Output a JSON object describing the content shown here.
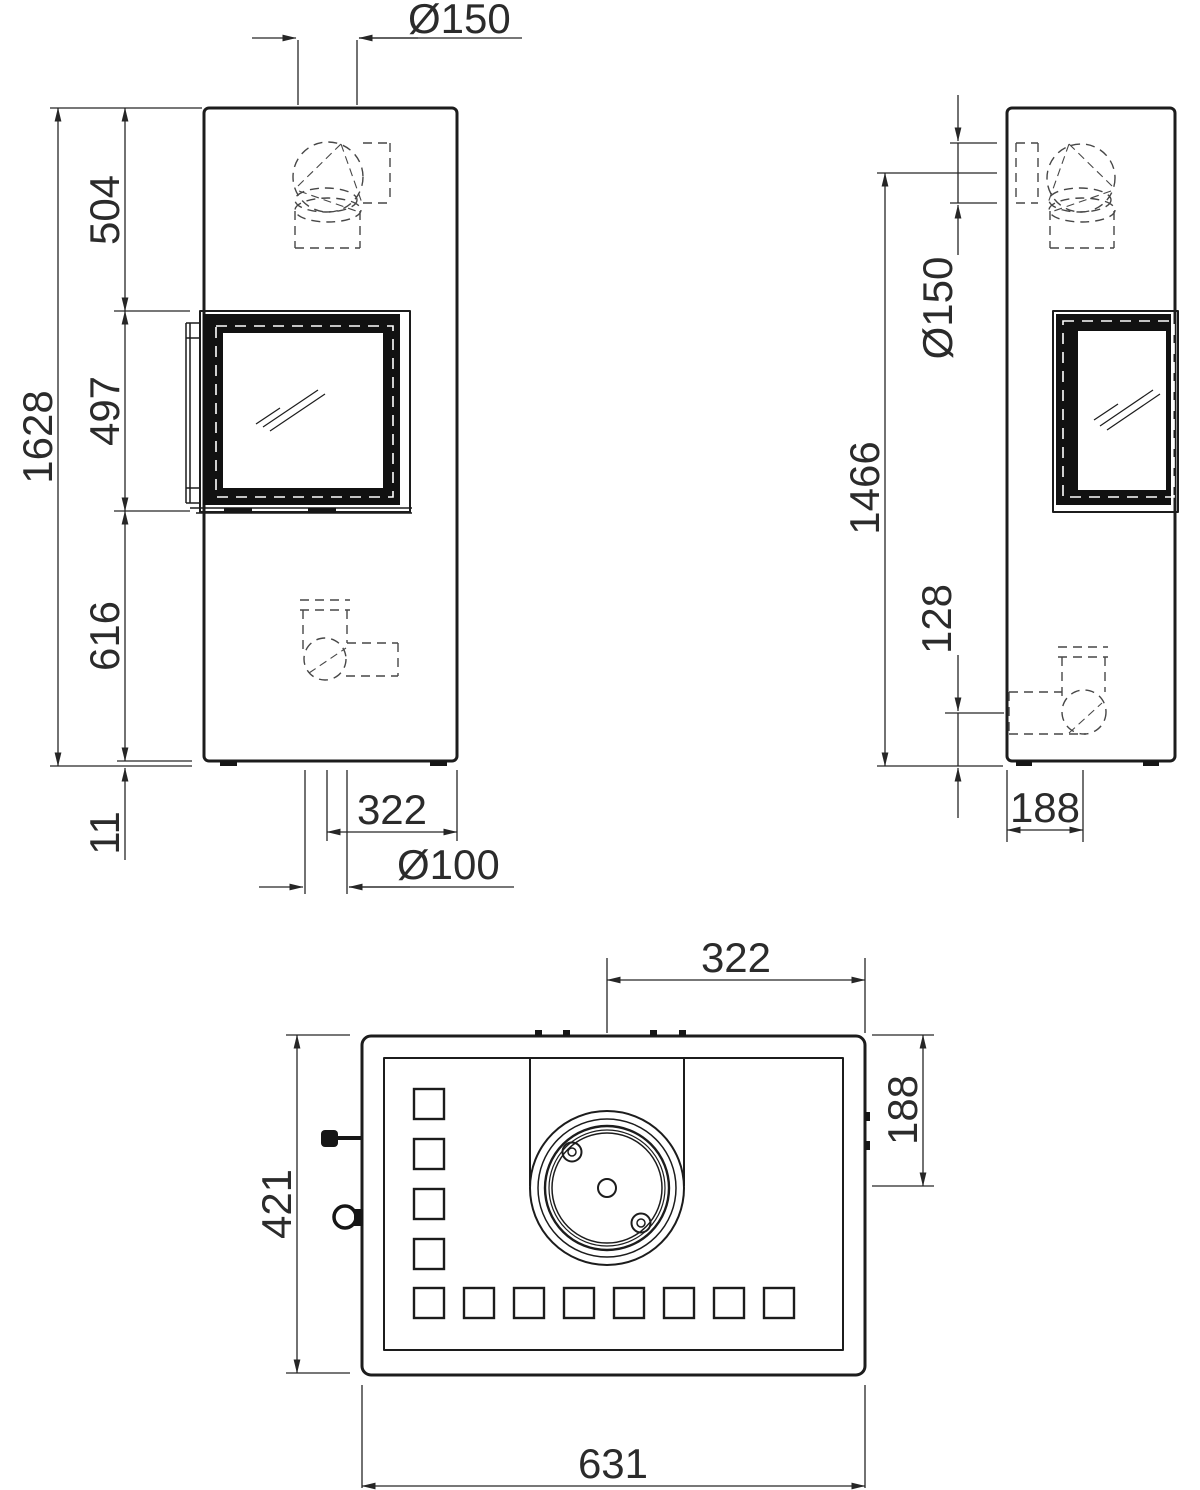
{
  "document": {
    "type": "technical-dimension-drawing",
    "subject": "stove three-view drawing"
  },
  "colors": {
    "background": "#ffffff",
    "line": "#1c1c1c",
    "hidden_line": "#474747",
    "text": "#2b2b2b"
  },
  "views": {
    "front": {
      "label": "front view",
      "dims": {
        "flue_diameter": "Ø150",
        "overall_height": "1628",
        "top_to_window": "504",
        "window_height": "497",
        "window_to_base": "616",
        "plinth_height": "11",
        "flue_center_to_side": "322",
        "intake_diameter": "Ø100"
      }
    },
    "side": {
      "label": "side view",
      "dims": {
        "flue_diameter": "Ø150",
        "rear_outlet_height": "1466",
        "intake_outlet_height": "128",
        "rear_to_outlet_center": "188"
      }
    },
    "top": {
      "label": "top view",
      "dims": {
        "flue_center_to_side": "322",
        "back_to_flue_center": "188",
        "depth": "421",
        "width": "631"
      }
    }
  }
}
